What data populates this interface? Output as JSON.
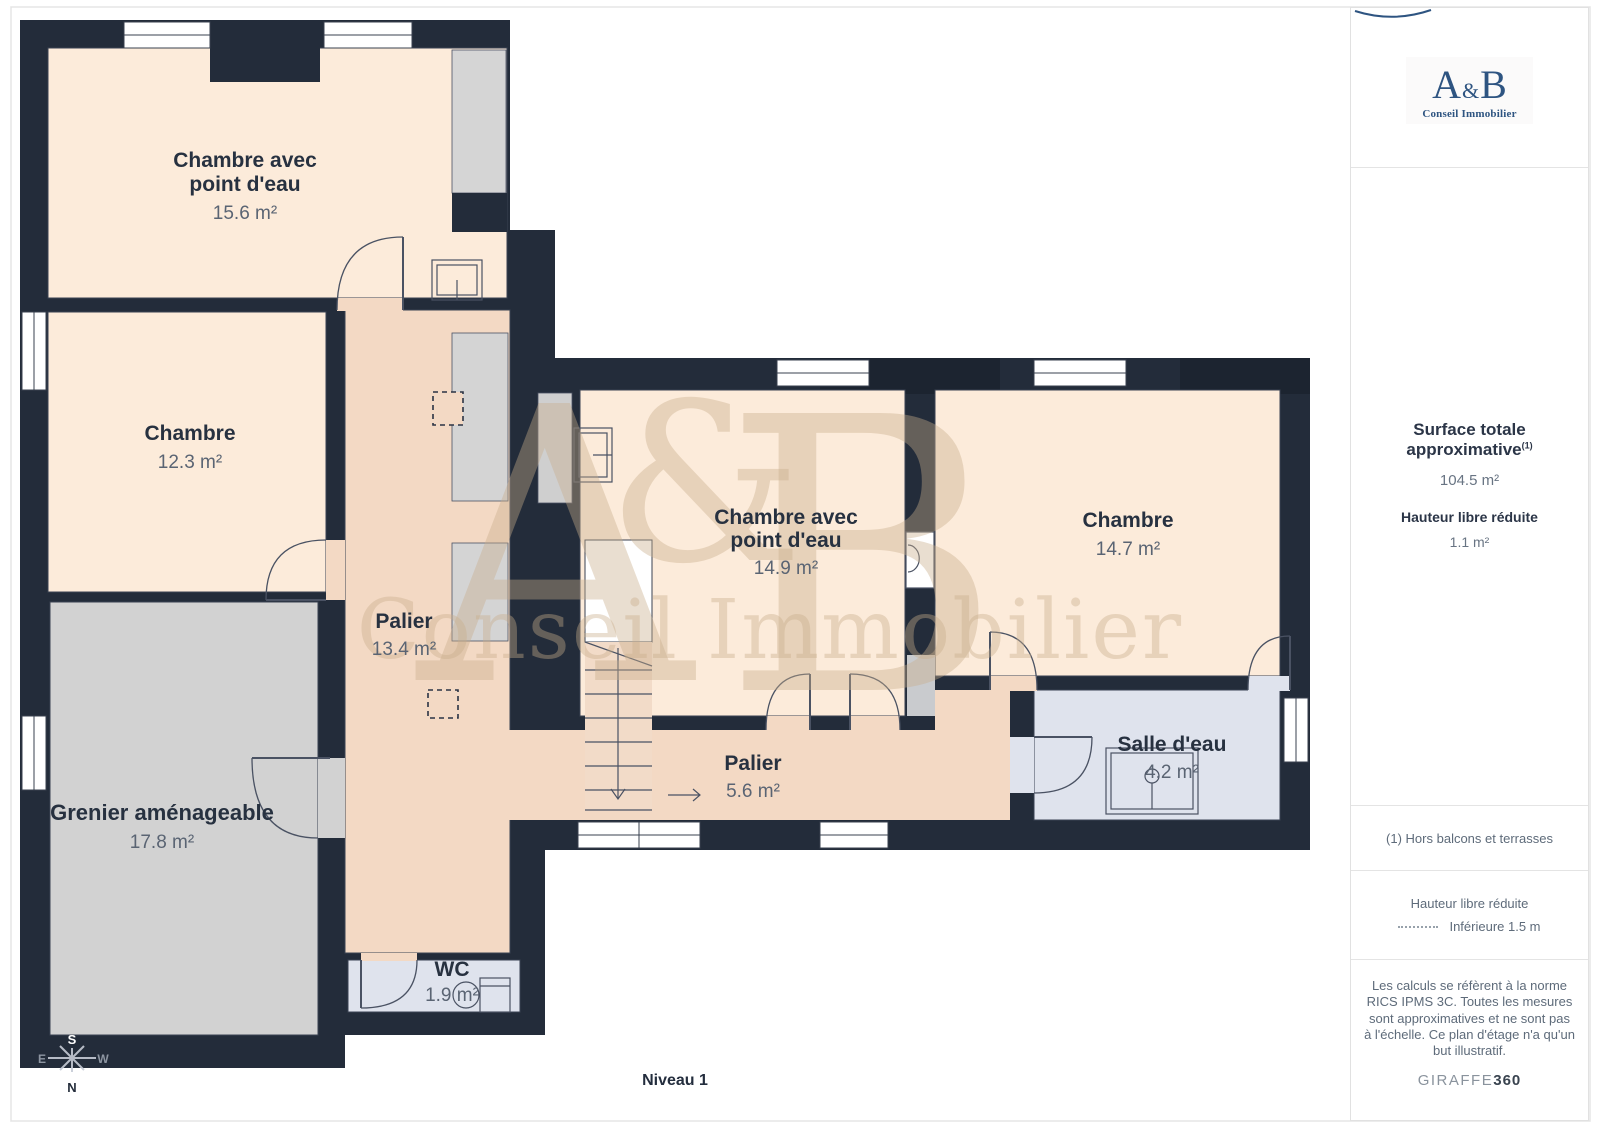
{
  "plan": {
    "watermark": {
      "part_a": "A",
      "part_amp": "&",
      "part_b": "B",
      "subtitle": "Conseil Immobilier"
    },
    "rooms": [
      {
        "line1": "Chambre avec",
        "line2": "point d'eau",
        "area": "15.6 m²"
      },
      {
        "line1": "Chambre",
        "area": "12.3 m²"
      },
      {
        "line1": "Grenier aménageable",
        "area": "17.8 m²"
      },
      {
        "line1": "Palier",
        "area": "13.4 m²"
      },
      {
        "line1": "Chambre avec",
        "line2": "point d'eau",
        "area": "14.9 m²"
      },
      {
        "line1": "Chambre",
        "area": "14.7 m²"
      },
      {
        "line1": "Palier",
        "area": "5.6 m²"
      },
      {
        "line1": "Salle d'eau",
        "area": "4.2 m²"
      },
      {
        "line1": "WC",
        "area": "1.9 m²"
      }
    ],
    "compass": {
      "n": "N",
      "s": "S",
      "e": "E",
      "w": "W"
    },
    "level_label": "Niveau 1",
    "colors": {
      "wall": "#232C3A",
      "room_peach": "#FCEBDA",
      "corridor_pink": "#F3D9C4",
      "attic_grey": "#D2D2D2",
      "wet_room_blue": "#DFE3ED"
    }
  },
  "sidebar": {
    "logo": {
      "part_a": "A",
      "part_amp": "&",
      "part_b": "B",
      "subtitle": "Conseil Immobilier",
      "color": "#2E5481"
    },
    "surface": {
      "title": "Surface totale approximative",
      "footnote_marker": "(1)",
      "value": "104.5 m²"
    },
    "height_reduced": {
      "title": "Hauteur libre réduite",
      "value": "1.1 m²"
    },
    "footnote": "(1) Hors balcons et terrasses",
    "legend": {
      "title": "Hauteur libre réduite",
      "item": "Inférieure 1.5 m"
    },
    "disclaimer": "Les calculs se réfèrent à la norme RICS IPMS 3C. Toutes les mesures sont approximatives et ne sont pas à l'échelle. Ce plan d'étage n'a qu'un but illustratif.",
    "brand": {
      "name": "GIRAFFE",
      "suffix": "360"
    }
  }
}
